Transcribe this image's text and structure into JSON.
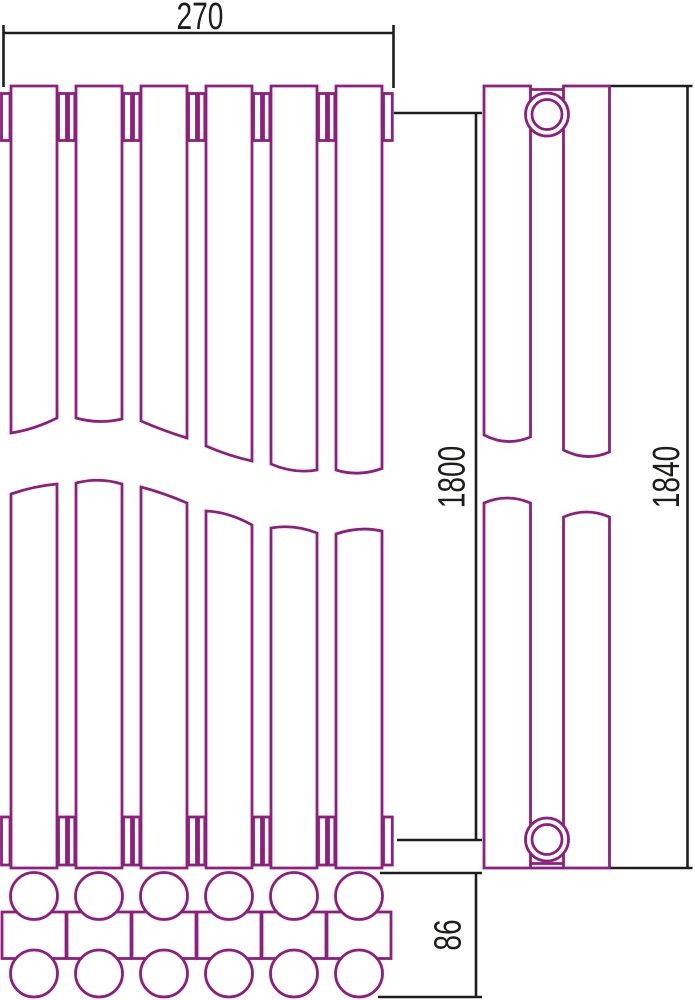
{
  "drawing": {
    "title": "radiator-technical-drawing",
    "dimensions": {
      "width_label": "270",
      "height_label": "1800",
      "overall_height_label": "1840",
      "depth_label": "86"
    },
    "colors": {
      "outline": "#8e1f7e",
      "dimension": "#1d1d1b",
      "background": "#ffffff"
    }
  }
}
